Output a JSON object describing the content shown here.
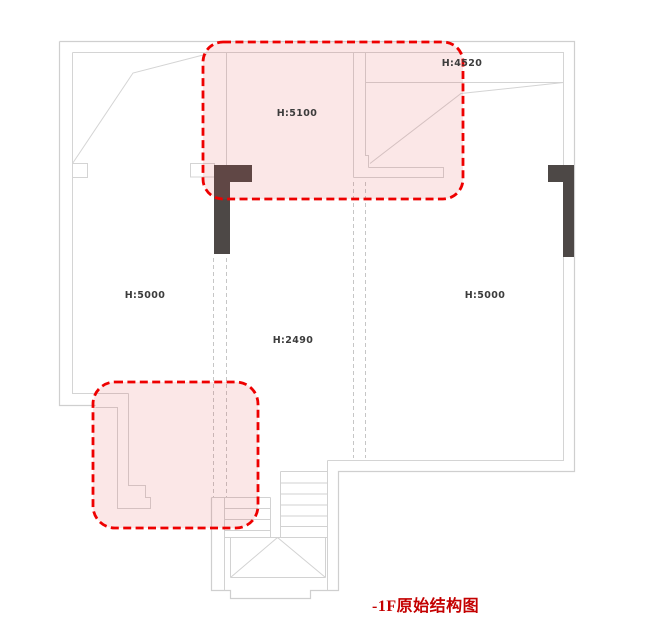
{
  "plan": {
    "title": "-1F原始结构图",
    "height_labels": [
      {
        "id": "top-right-room",
        "text": "H:4520"
      },
      {
        "id": "top-center-room",
        "text": "H:5100"
      },
      {
        "id": "left-area",
        "text": "H:5000"
      },
      {
        "id": "right-area",
        "text": "H:5000"
      },
      {
        "id": "center-area",
        "text": "H:2490"
      }
    ],
    "colors": {
      "wall_line": "#cfcfcf",
      "stair_line": "#d2d2d2",
      "projection_dashed_line": "#c6c6c6",
      "structural_column_fill": "#4d4846",
      "highlight_stroke": "#ee0000",
      "highlight_fill": "rgba(221,73,73,0.13)",
      "label_color": "#3c3c3c",
      "caption_color": "#c40000"
    }
  }
}
